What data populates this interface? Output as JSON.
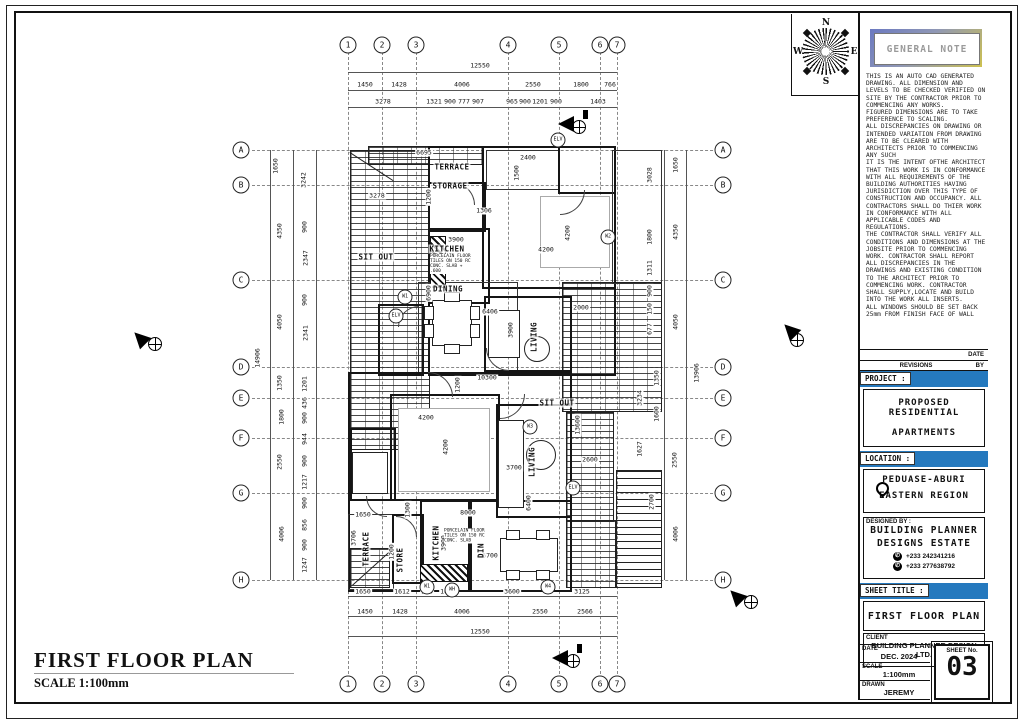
{
  "page": {
    "title": "FIRST FLOOR PLAN",
    "scale_label": "SCALE 1:100mm"
  },
  "compass": {
    "n": "N",
    "e": "E",
    "s": "S",
    "w": "W"
  },
  "grid": {
    "cols": [
      {
        "label": "1",
        "x": 348
      },
      {
        "label": "2",
        "x": 382
      },
      {
        "label": "3",
        "x": 416
      },
      {
        "label": "4",
        "x": 508
      },
      {
        "label": "5",
        "x": 559
      },
      {
        "label": "6",
        "x": 600
      },
      {
        "label": "7",
        "x": 617
      }
    ],
    "rows": [
      {
        "label": "A",
        "y": 150
      },
      {
        "label": "B",
        "y": 185
      },
      {
        "label": "C",
        "y": 280
      },
      {
        "label": "D",
        "y": 367
      },
      {
        "label": "E",
        "y": 398
      },
      {
        "label": "F",
        "y": 438
      },
      {
        "label": "G",
        "y": 493
      },
      {
        "label": "H",
        "y": 580
      }
    ]
  },
  "dims": {
    "top": [
      {
        "t": "12550",
        "x": 480,
        "y": 66
      },
      {
        "t": "1450",
        "x": 365,
        "y": 85
      },
      {
        "t": "1428",
        "x": 399,
        "y": 85
      },
      {
        "t": "4006",
        "x": 462,
        "y": 85
      },
      {
        "t": "2550",
        "x": 533,
        "y": 85
      },
      {
        "t": "1800",
        "x": 581,
        "y": 85
      },
      {
        "t": "766",
        "x": 610,
        "y": 85
      },
      {
        "t": "3278",
        "x": 383,
        "y": 102
      },
      {
        "t": "1321",
        "x": 434,
        "y": 102
      },
      {
        "t": "900",
        "x": 450,
        "y": 102
      },
      {
        "t": "777",
        "x": 464,
        "y": 102
      },
      {
        "t": "907",
        "x": 478,
        "y": 102
      },
      {
        "t": "965",
        "x": 512,
        "y": 102
      },
      {
        "t": "900",
        "x": 525,
        "y": 102
      },
      {
        "t": "1201",
        "x": 540,
        "y": 102
      },
      {
        "t": "900",
        "x": 556,
        "y": 102
      },
      {
        "t": "1403",
        "x": 598,
        "y": 102
      }
    ],
    "bottom": [
      {
        "t": "1650",
        "x": 363,
        "y": 592
      },
      {
        "t": "1612",
        "x": 402,
        "y": 592
      },
      {
        "t": "900",
        "x": 427,
        "y": 592
      },
      {
        "t": "1664",
        "x": 448,
        "y": 592
      },
      {
        "t": "3600",
        "x": 512,
        "y": 592
      },
      {
        "t": "3125",
        "x": 582,
        "y": 592
      },
      {
        "t": "1450",
        "x": 365,
        "y": 612
      },
      {
        "t": "1428",
        "x": 400,
        "y": 612
      },
      {
        "t": "4006",
        "x": 462,
        "y": 612
      },
      {
        "t": "2550",
        "x": 540,
        "y": 612
      },
      {
        "t": "2566",
        "x": 585,
        "y": 612
      },
      {
        "t": "12550",
        "x": 480,
        "y": 632
      }
    ],
    "left": [
      {
        "t": "14906",
        "x": 258,
        "y": 358,
        "rot": 1
      },
      {
        "t": "1650",
        "x": 276,
        "y": 166,
        "rot": 1
      },
      {
        "t": "4350",
        "x": 280,
        "y": 231,
        "rot": 1
      },
      {
        "t": "4050",
        "x": 280,
        "y": 322,
        "rot": 1
      },
      {
        "t": "1350",
        "x": 280,
        "y": 383,
        "rot": 1
      },
      {
        "t": "1800",
        "x": 282,
        "y": 417,
        "rot": 1
      },
      {
        "t": "2550",
        "x": 280,
        "y": 462,
        "rot": 1
      },
      {
        "t": "4006",
        "x": 282,
        "y": 534,
        "rot": 1
      },
      {
        "t": "3242",
        "x": 304,
        "y": 180,
        "rot": 1
      },
      {
        "t": "900",
        "x": 305,
        "y": 227,
        "rot": 1
      },
      {
        "t": "2347",
        "x": 306,
        "y": 258,
        "rot": 1
      },
      {
        "t": "900",
        "x": 305,
        "y": 300,
        "rot": 1
      },
      {
        "t": "2341",
        "x": 306,
        "y": 333,
        "rot": 1
      },
      {
        "t": "1201",
        "x": 305,
        "y": 384,
        "rot": 1
      },
      {
        "t": "436",
        "x": 305,
        "y": 403,
        "rot": 1
      },
      {
        "t": "900",
        "x": 305,
        "y": 418,
        "rot": 1
      },
      {
        "t": "944",
        "x": 305,
        "y": 439,
        "rot": 1
      },
      {
        "t": "900",
        "x": 305,
        "y": 461,
        "rot": 1
      },
      {
        "t": "1217",
        "x": 305,
        "y": 482,
        "rot": 1
      },
      {
        "t": "900",
        "x": 305,
        "y": 503,
        "rot": 1
      },
      {
        "t": "856",
        "x": 305,
        "y": 525,
        "rot": 1
      },
      {
        "t": "900",
        "x": 305,
        "y": 545,
        "rot": 1
      },
      {
        "t": "1247",
        "x": 305,
        "y": 565,
        "rot": 1
      }
    ],
    "right": [
      {
        "t": "13906",
        "x": 697,
        "y": 373,
        "rot": 1
      },
      {
        "t": "1650",
        "x": 676,
        "y": 165,
        "rot": 1
      },
      {
        "t": "4350",
        "x": 676,
        "y": 232,
        "rot": 1
      },
      {
        "t": "4050",
        "x": 676,
        "y": 322,
        "rot": 1
      },
      {
        "t": "1350",
        "x": 657,
        "y": 378,
        "rot": 1
      },
      {
        "t": "1600",
        "x": 657,
        "y": 414,
        "rot": 1
      },
      {
        "t": "2550",
        "x": 675,
        "y": 460,
        "rot": 1
      },
      {
        "t": "2700",
        "x": 652,
        "y": 502,
        "rot": 1
      },
      {
        "t": "4006",
        "x": 676,
        "y": 534,
        "rot": 1
      },
      {
        "t": "3028",
        "x": 650,
        "y": 175,
        "rot": 1
      },
      {
        "t": "1800",
        "x": 650,
        "y": 237,
        "rot": 1
      },
      {
        "t": "1311",
        "x": 650,
        "y": 268,
        "rot": 1
      },
      {
        "t": "900",
        "x": 650,
        "y": 291,
        "rot": 1
      },
      {
        "t": "150",
        "x": 650,
        "y": 309,
        "rot": 1
      },
      {
        "t": "677",
        "x": 650,
        "y": 329,
        "rot": 1
      },
      {
        "t": "3234",
        "x": 640,
        "y": 398,
        "rot": 1
      },
      {
        "t": "1627",
        "x": 640,
        "y": 449,
        "rot": 1
      }
    ]
  },
  "plan": {
    "rooms": [
      {
        "t": "TERRACE",
        "x": 452,
        "y": 167
      },
      {
        "t": "STORAGE",
        "x": 450,
        "y": 186
      },
      {
        "t": "SIT OUT",
        "x": 376,
        "y": 257
      },
      {
        "t": "KITCHEN",
        "x": 447,
        "y": 249
      },
      {
        "t": "DINING",
        "x": 448,
        "y": 289
      },
      {
        "t": "LIVING",
        "x": 534,
        "y": 337,
        "rot": 1
      },
      {
        "t": "SIT OUT",
        "x": 557,
        "y": 403
      },
      {
        "t": "LIVING",
        "x": 532,
        "y": 462,
        "rot": 1
      },
      {
        "t": "TERRACE",
        "x": 366,
        "y": 549,
        "rot": 1
      },
      {
        "t": "STORE",
        "x": 400,
        "y": 560,
        "rot": 1
      },
      {
        "t": "KITCHEN",
        "x": 436,
        "y": 543,
        "rot": 1
      },
      {
        "t": "DINING",
        "x": 481,
        "y": 543,
        "rot": 1
      }
    ],
    "inner_dims": [
      {
        "t": "6695",
        "x": 424,
        "y": 153
      },
      {
        "t": "2400",
        "x": 528,
        "y": 158
      },
      {
        "t": "1500",
        "x": 517,
        "y": 173,
        "rot": 1
      },
      {
        "t": "1200",
        "x": 429,
        "y": 197,
        "rot": 1
      },
      {
        "t": "1306",
        "x": 484,
        "y": 211
      },
      {
        "t": "3900",
        "x": 456,
        "y": 240
      },
      {
        "t": "4200",
        "x": 546,
        "y": 250
      },
      {
        "t": "4200",
        "x": 568,
        "y": 233,
        "rot": 1
      },
      {
        "t": "3278",
        "x": 377,
        "y": 196
      },
      {
        "t": "6900",
        "x": 429,
        "y": 293,
        "rot": 1
      },
      {
        "t": "6406",
        "x": 490,
        "y": 312
      },
      {
        "t": "3900",
        "x": 511,
        "y": 330,
        "rot": 1
      },
      {
        "t": "2000",
        "x": 581,
        "y": 308
      },
      {
        "t": "10300",
        "x": 487,
        "y": 378
      },
      {
        "t": "1200",
        "x": 458,
        "y": 385,
        "rot": 1
      },
      {
        "t": "4200",
        "x": 426,
        "y": 418
      },
      {
        "t": "4200",
        "x": 446,
        "y": 447,
        "rot": 1
      },
      {
        "t": "13600",
        "x": 578,
        "y": 425,
        "rot": 1
      },
      {
        "t": "2600",
        "x": 590,
        "y": 460
      },
      {
        "t": "3700",
        "x": 514,
        "y": 468
      },
      {
        "t": "6400",
        "x": 529,
        "y": 503,
        "rot": 1
      },
      {
        "t": "1300",
        "x": 408,
        "y": 510,
        "rot": 1
      },
      {
        "t": "1650",
        "x": 363,
        "y": 515
      },
      {
        "t": "3706",
        "x": 354,
        "y": 538,
        "rot": 1
      },
      {
        "t": "1200",
        "x": 392,
        "y": 552,
        "rot": 1
      },
      {
        "t": "3900",
        "x": 444,
        "y": 543,
        "rot": 1
      },
      {
        "t": "8000",
        "x": 468,
        "y": 513
      },
      {
        "t": "6700",
        "x": 490,
        "y": 556
      }
    ],
    "markers": [
      {
        "t": "W1",
        "x": 405,
        "y": 297
      },
      {
        "t": "W2",
        "x": 608,
        "y": 237
      },
      {
        "t": "W3",
        "x": 530,
        "y": 427
      },
      {
        "t": "W1",
        "x": 427,
        "y": 587
      },
      {
        "t": "W4",
        "x": 548,
        "y": 587
      },
      {
        "t": "WH",
        "x": 452,
        "y": 590
      },
      {
        "t": "ELV",
        "x": 558,
        "y": 140
      },
      {
        "t": "ELV",
        "x": 396,
        "y": 316
      },
      {
        "t": "ELV",
        "x": 573,
        "y": 488
      }
    ],
    "notes": [
      {
        "t": "PORCELAIN FLOOR TILES ON 150 RC CONC. SLAB + .600",
        "x": 452,
        "y": 264
      },
      {
        "t": "PORCELAIN FLOOR TILES ON 150 RC CONC. SLAB",
        "x": 466,
        "y": 536
      }
    ]
  },
  "titleblock": {
    "general_note": {
      "title": "GENERAL NOTE",
      "body": "THIS IS AN AUTO CAD GENERATED DRAWING. ALL DIMENSION AND LEVELS TO BE CHECKED VERIFIED ON SITE BY THE CONTRACTOR PRIOR TO COMMENCING ANY WORKS.\nFIGURED DIMENSIONS ARE TO TAKE PREFERENCE TO SCALING.\nALL DISCREPANCIES ON DRAWING OR INTENDED VARIATION FROM DRAWING ARE TO BE CLEARED WITH ARCHITECTS PRIOR TO COMMENCING ANY SUCH\nIT IS THE INTENT OFTHE ARCHITECT THAT THIS WORK IS IN CONFORMANCE WITH ALL REQUIREMENTS OF THE BUILDING AUTHORITIES HAVING JURISDICTION OVER THIS TYPE OF CONSTRUCTION AND OCCUPANCY. ALL CONTRACTORS SHALL DO THIER WORK IN CONFORMANCE WITH ALL APPLICABLE CODES AND REGULATIONS.\nTHE CONTRACTOR SHALL VERIFY ALL CONDITIONS AND DIMENSIONS AT THE JOBSITE PRIOR TO COMMENCING WORK. CONTRACTOR SHALL REPORT ALL DISCREPANCIES IN THE DRAWINGS AND EXISTING CONDITION TO THE ARCHITECT PRIOR TO COMMENCING WORK. CONTRACTOR SHALL SUPPLY,LOCATE AND BUILD INTO THE WORK ALL INSERTS.\nALL WINDOWS SHOULD BE SET BACK 25mm FROM FINISH FACE OF WALL"
    },
    "revisions": {
      "date_label": "DATE",
      "title": "REVISIONS",
      "by_label": "BY"
    },
    "project": {
      "label": "PROJECT :",
      "line1": "PROPOSED RESIDENTIAL",
      "line2": "APARTMENTS"
    },
    "location": {
      "label": "LOCATION :",
      "line1": "PEDUASE-ABURI",
      "line2": "EASTERN REGION"
    },
    "designed_by": {
      "label": "DESIGNED BY :",
      "line1": "BUILDING PLANNER",
      "line2": "DESIGNS ESTATE",
      "phone_icon": "✆",
      "phone1": "+233  242341216",
      "phone2": "+233  277638792"
    },
    "sheet_title": {
      "label": "SHEET TITLE :",
      "value": "FIRST FLOOR PLAN"
    },
    "client": {
      "label": "CLIENT",
      "value": "BUILDING PLANNER DESIGN LTD."
    },
    "meta": {
      "date_label": "DATE",
      "date": "DEC. 2024",
      "scale_label": "SCALE",
      "scale": "1:100mm",
      "drawn_label": "DRAWN",
      "drawn": "JEREMY",
      "sheet_no_label": "SHEET No.",
      "sheet_no": "03"
    }
  }
}
